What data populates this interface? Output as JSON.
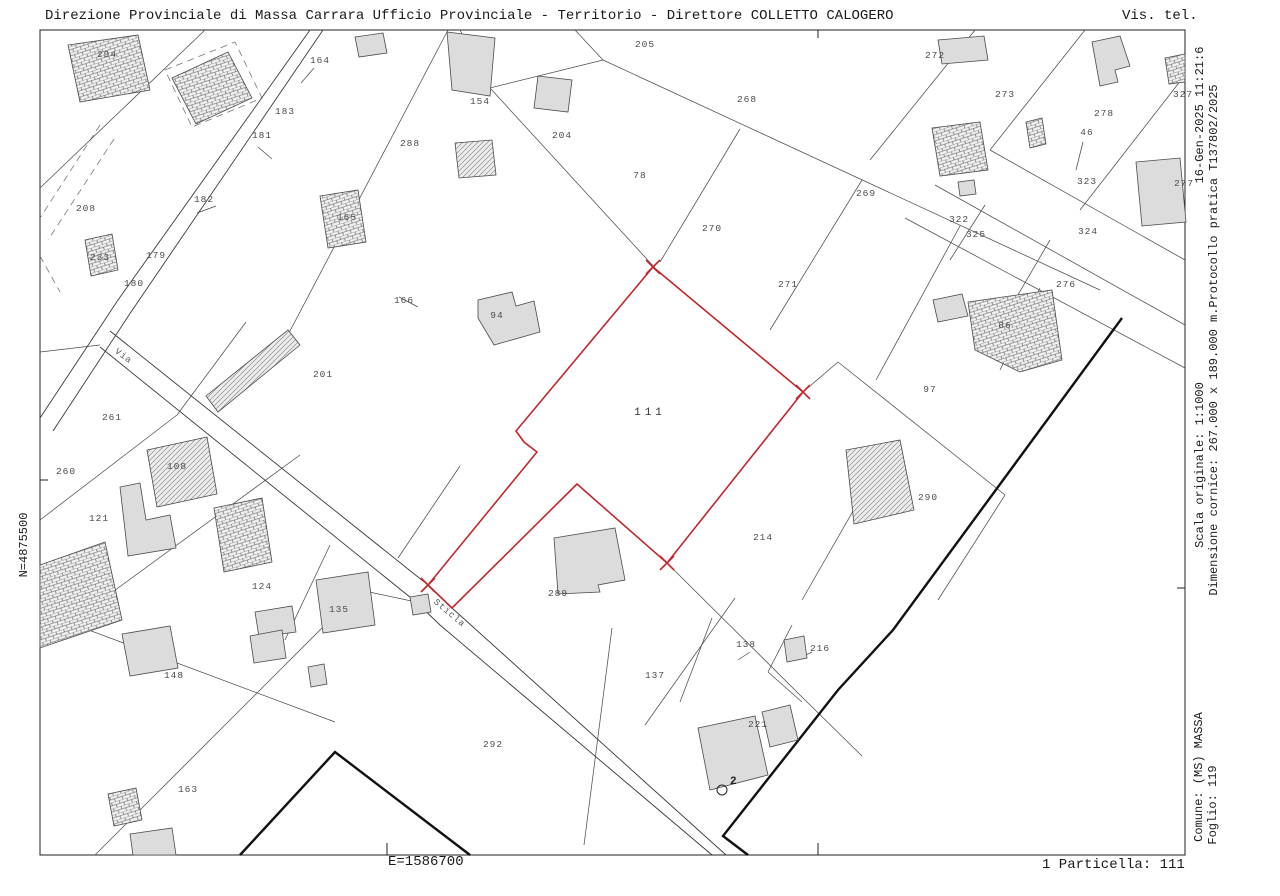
{
  "header": {
    "left": "Direzione Provinciale di Massa Carrara  Ufficio Provinciale - Territorio - Direttore COLLETTO CALOGERO",
    "right": "Vis. tel."
  },
  "margins": {
    "right_inner_top": "16-Gen-2025 11:21:6",
    "right_inner_middle": "Scala originale: 1:1000",
    "right_inner_bottom": "Comune: (MS) MASSA",
    "right_outer_top": "Dimensione cornice: 267.000 x 189.000 m.Protocollo pratica T137802/2025",
    "right_outer_bottom": "Foglio: 119",
    "left_north": "N=4875500",
    "bottom_east": "E=1586700",
    "bottom_right": "1 Particella: 111"
  },
  "map": {
    "highlight_color": "#c1272d",
    "highlighted_parcel": "111",
    "parcel_labels": [
      {
        "t": "294",
        "x": 107,
        "y": 57
      },
      {
        "t": "164",
        "x": 320,
        "y": 63
      },
      {
        "t": "183",
        "x": 285,
        "y": 114
      },
      {
        "t": "181",
        "x": 262,
        "y": 138
      },
      {
        "t": "288",
        "x": 410,
        "y": 146
      },
      {
        "t": "208",
        "x": 86,
        "y": 211
      },
      {
        "t": "182",
        "x": 204,
        "y": 202
      },
      {
        "t": "179",
        "x": 156,
        "y": 258
      },
      {
        "t": "180",
        "x": 134,
        "y": 286
      },
      {
        "t": "233",
        "x": 100,
        "y": 260
      },
      {
        "t": "165",
        "x": 347,
        "y": 220
      },
      {
        "t": "166",
        "x": 404,
        "y": 303
      },
      {
        "t": "205",
        "x": 645,
        "y": 47
      },
      {
        "t": "154",
        "x": 480,
        "y": 104
      },
      {
        "t": "204",
        "x": 562,
        "y": 138
      },
      {
        "t": "78",
        "x": 640,
        "y": 178
      },
      {
        "t": "268",
        "x": 747,
        "y": 102
      },
      {
        "t": "269",
        "x": 866,
        "y": 196
      },
      {
        "t": "270",
        "x": 712,
        "y": 231
      },
      {
        "t": "271",
        "x": 788,
        "y": 287
      },
      {
        "t": "94",
        "x": 497,
        "y": 318
      },
      {
        "t": "272",
        "x": 935,
        "y": 58
      },
      {
        "t": "273",
        "x": 1005,
        "y": 97
      },
      {
        "t": "278",
        "x": 1104,
        "y": 116
      },
      {
        "t": "327",
        "x": 1183,
        "y": 97
      },
      {
        "t": "46",
        "x": 1087,
        "y": 135
      },
      {
        "t": "322",
        "x": 959,
        "y": 222
      },
      {
        "t": "323",
        "x": 1087,
        "y": 184
      },
      {
        "t": "325",
        "x": 976,
        "y": 237
      },
      {
        "t": "324",
        "x": 1088,
        "y": 234
      },
      {
        "t": "276",
        "x": 1066,
        "y": 287
      },
      {
        "t": "277",
        "x": 1184,
        "y": 186
      },
      {
        "t": "86",
        "x": 1005,
        "y": 328
      },
      {
        "t": "97",
        "x": 930,
        "y": 392
      },
      {
        "t": "290",
        "x": 928,
        "y": 500
      },
      {
        "t": "201",
        "x": 323,
        "y": 377
      },
      {
        "t": "261",
        "x": 112,
        "y": 420
      },
      {
        "t": "260",
        "x": 66,
        "y": 474
      },
      {
        "t": "108",
        "x": 177,
        "y": 469
      },
      {
        "t": "121",
        "x": 99,
        "y": 521
      },
      {
        "t": "124",
        "x": 262,
        "y": 589
      },
      {
        "t": "135",
        "x": 339,
        "y": 612
      },
      {
        "t": "148",
        "x": 174,
        "y": 678
      },
      {
        "t": "163",
        "x": 188,
        "y": 792
      },
      {
        "t": "111",
        "x": 650,
        "y": 415
      },
      {
        "t": "214",
        "x": 763,
        "y": 540
      },
      {
        "t": "289",
        "x": 558,
        "y": 596
      },
      {
        "t": "292",
        "x": 493,
        "y": 747
      },
      {
        "t": "137",
        "x": 655,
        "y": 678
      },
      {
        "t": "138",
        "x": 746,
        "y": 647
      },
      {
        "t": "216",
        "x": 820,
        "y": 651
      },
      {
        "t": "221",
        "x": 758,
        "y": 727
      }
    ],
    "road_labels": [
      {
        "t": "Via",
        "x": 122,
        "y": 358,
        "a": 37
      },
      {
        "t": "Sticla",
        "x": 448,
        "y": 615,
        "a": 40
      }
    ],
    "survey_point": {
      "label": "2",
      "x": 722,
      "y": 790
    }
  }
}
